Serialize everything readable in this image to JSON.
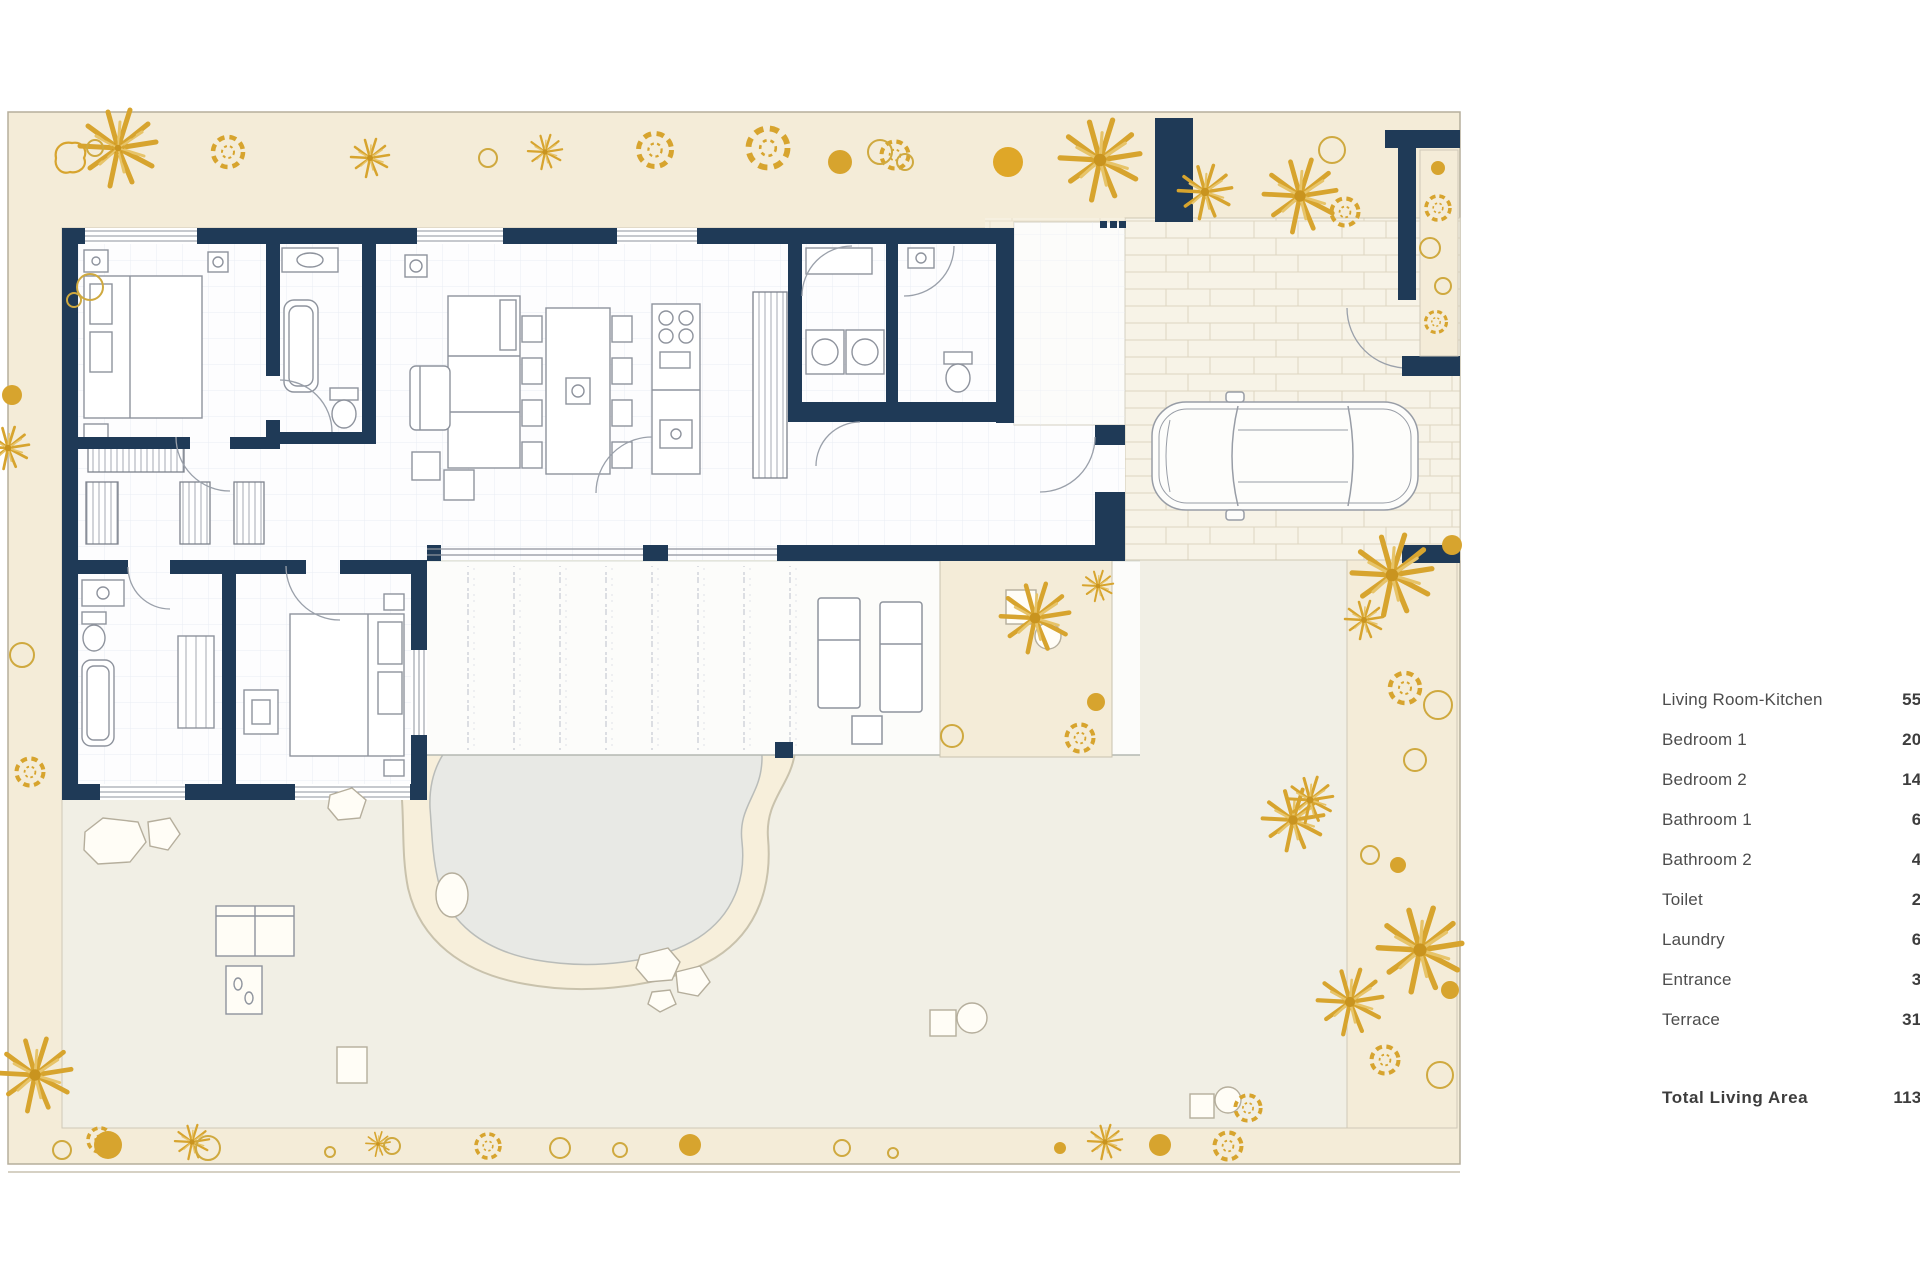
{
  "legend": {
    "rows": [
      {
        "label": "Living Room-Kitchen",
        "value": "55,1"
      },
      {
        "label": "Bedroom 1",
        "value": "20,1"
      },
      {
        "label": "Bedroom  2",
        "value": "14,1"
      },
      {
        "label": "Bathroom 1",
        "value": "6,0"
      },
      {
        "label": "Bathroom 2",
        "value": "4,6"
      },
      {
        "label": "Toilet",
        "value": "2,3"
      },
      {
        "label": "Laundry",
        "value": "6,7"
      },
      {
        "label": "Entrance",
        "value": "3,0"
      },
      {
        "label": "Terrace",
        "value": "31,9"
      }
    ],
    "total_label": "Total Living Area",
    "total_value": "113,6"
  },
  "palette": {
    "wall_navy": "#1f3a57",
    "garden_cream": "#f4ecd8",
    "garden_inner": "#f1efe5",
    "plant_gold": "#d7a42e",
    "pool_water": "#e8e9e5",
    "pool_deck": "#f7efdb",
    "furniture_line": "#8e939d"
  }
}
